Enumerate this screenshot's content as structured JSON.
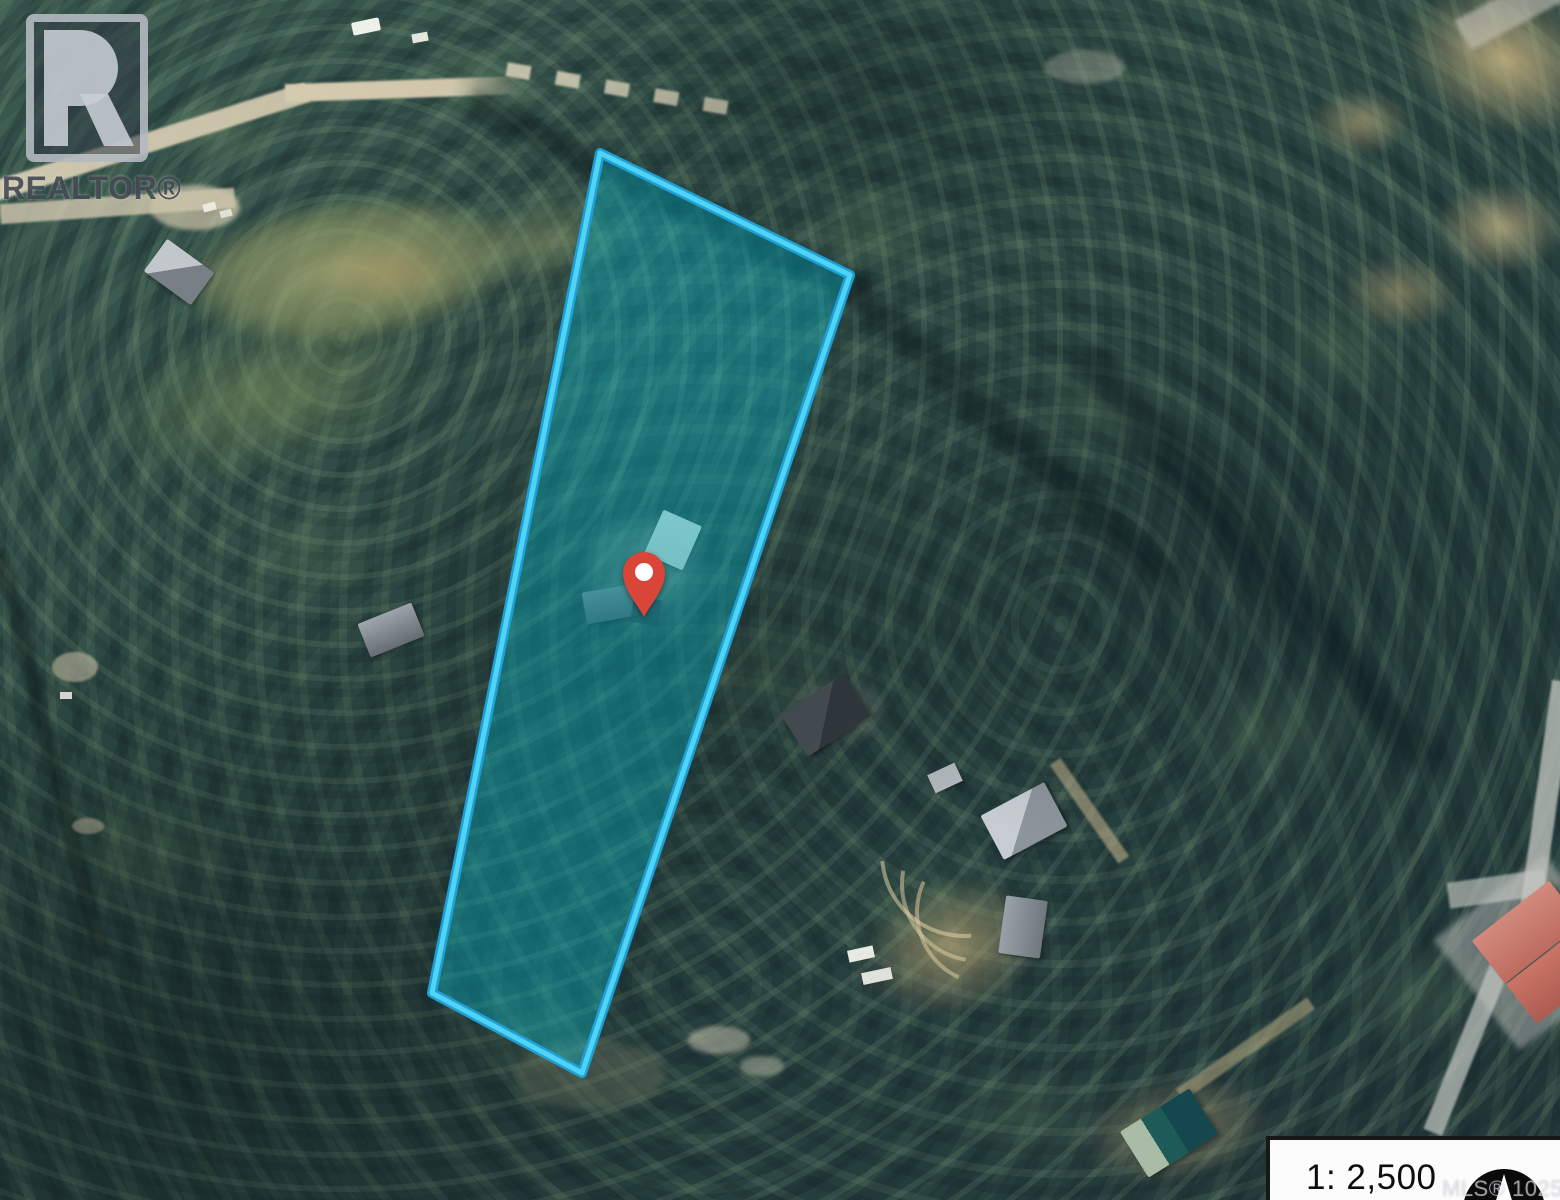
{
  "watermark": {
    "brand": "REALTOR®",
    "logo_icon": "realtor-r-icon"
  },
  "scale_panel": {
    "scale_label": "1: 2,500",
    "mls_label": "MLS® 1025715",
    "north_icon": "north-arrow-icon"
  },
  "map": {
    "type": "aerial-satellite-photo",
    "boundary": {
      "points": "600,153 850,275 582,1073 432,993",
      "stroke_color": "#4fd4f6",
      "stroke_outer_color": "#1f9fd6",
      "fill_color": "rgba(0,207,228,0.33)"
    },
    "pin": {
      "transform": "translate(644,574)",
      "color": "#da453a",
      "hole_color": "#ffffff"
    },
    "colors": {
      "forest_dark": "#223739",
      "forest_mid": "#3a5a50",
      "canopy_light": "#7ba26f",
      "road_tan": "#d2c9ae",
      "dirt_brown": "#bca678",
      "meadow_olive": "#9aa472",
      "roof_gray": "#aab2b8",
      "roof_dark": "#3c4348",
      "roof_red": "#c97567",
      "roof_teal": "#1d5a58"
    }
  }
}
